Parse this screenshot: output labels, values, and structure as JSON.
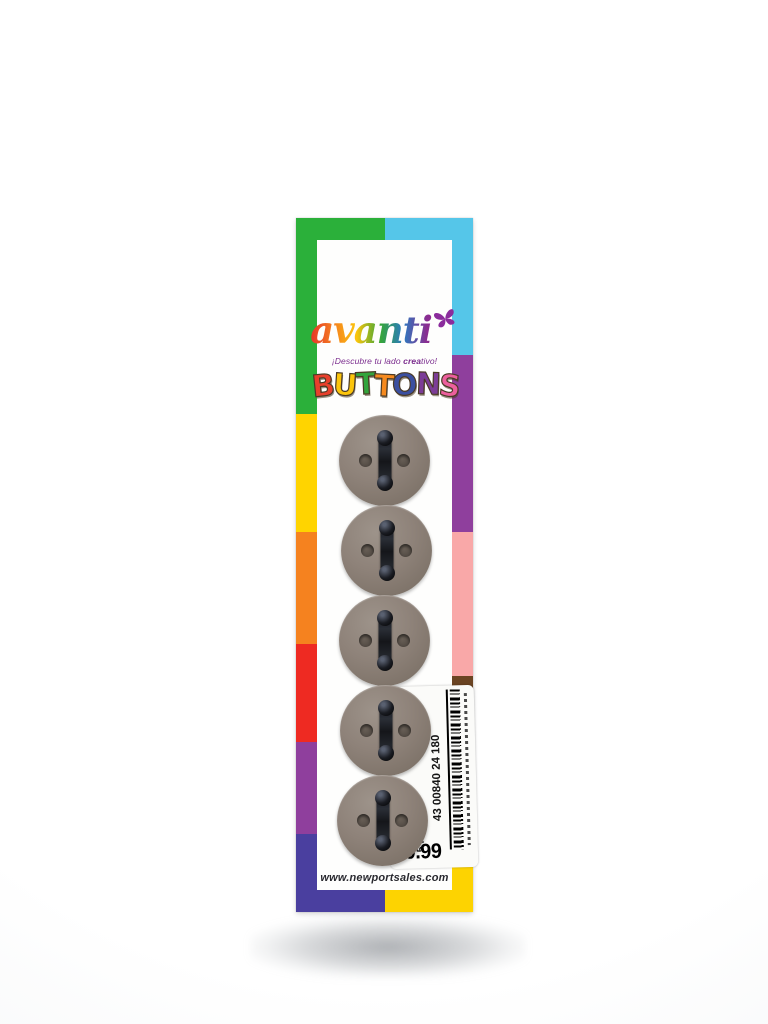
{
  "card": {
    "brand": {
      "name": "avanti",
      "tagline_pre": "¡Descubre tu lado ",
      "tagline_bold": "crea",
      "tagline_post": "tivo!",
      "tagline_color": "#7b2d8e",
      "butterfly_color": "#8b2c9c",
      "logo_gradient": [
        "#e5332a",
        "#f5821f",
        "#fcc50b",
        "#36a53a",
        "#2b7bbf",
        "#8b2c90"
      ]
    },
    "title": {
      "text": "BUTTONS",
      "outline_color": "#4a3a25",
      "letters": [
        {
          "char": "B",
          "color": "#e8402c"
        },
        {
          "char": "U",
          "color": "#fcc50b"
        },
        {
          "char": "T",
          "color": "#33a43c"
        },
        {
          "char": "T",
          "color": "#f68a1f"
        },
        {
          "char": "O",
          "color": "#3b4fa0"
        },
        {
          "char": "N",
          "color": "#7c3d97"
        },
        {
          "char": "S",
          "color": "#ec5f9d"
        }
      ]
    },
    "buttons": {
      "count": 5,
      "face_color": "#8e8279",
      "hole_color": "#544c45",
      "thread_color": "#181a1f"
    },
    "sticker": {
      "style_number": "(#24)",
      "lot_number": "7025",
      "pieces": "5 PCS.",
      "barcode_number": "43 00840 24 180",
      "price": "$0.99"
    },
    "website": "www.newportsales.com",
    "border": {
      "top": [
        {
          "color": "#2bb03a",
          "size": 1
        },
        {
          "color": "#55c6e9",
          "size": 1
        }
      ],
      "bottom": [
        {
          "color": "#4a3f9f",
          "size": 1
        },
        {
          "color": "#fdd301",
          "size": 1
        }
      ],
      "left": [
        {
          "color": "#2bb03a",
          "size": 186
        },
        {
          "color": "#ffd400",
          "size": 126
        },
        {
          "color": "#f5821f",
          "size": 119
        },
        {
          "color": "#ee2a22",
          "size": 105
        },
        {
          "color": "#8f3f9d",
          "size": 98
        },
        {
          "color": "#4a3f9f",
          "size": 60
        }
      ],
      "right": [
        {
          "color": "#55c6e9",
          "size": 123
        },
        {
          "color": "#8f3f9d",
          "size": 189
        },
        {
          "color": "#f9a8a8",
          "size": 154
        },
        {
          "color": "#6b4423",
          "size": 140
        },
        {
          "color": "#f5821f",
          "size": 27
        },
        {
          "color": "#fdd301",
          "size": 61
        }
      ]
    }
  }
}
